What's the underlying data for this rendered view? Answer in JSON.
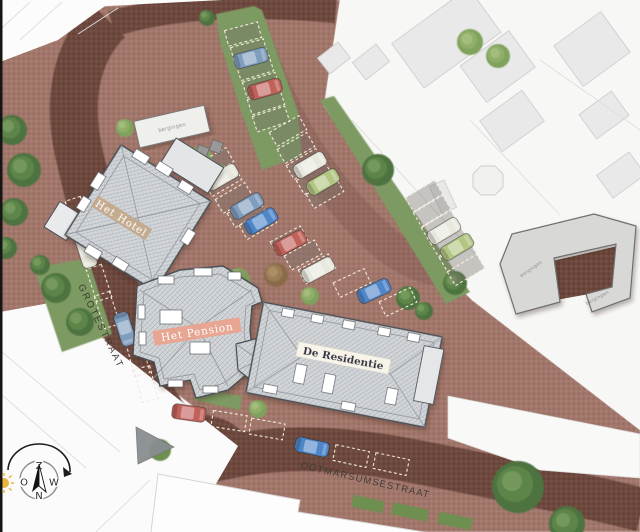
{
  "plan": {
    "labels": {
      "hotel": "Het Hotel",
      "pension": "Het Pension",
      "residentie": "De Residentie",
      "storage": "bergingen"
    },
    "streets": {
      "grotestraat": "GROTESTRAAT",
      "ootmarsumsestraat": "OOTMARSUMSESTRAAT"
    },
    "compass": {
      "top": "Z",
      "bottom": "N",
      "left": "O",
      "right": "W"
    },
    "colors": {
      "plaza_brick": "#a3766a",
      "road_brick": "#6e483d",
      "grass": "#7d9a62",
      "tree": "#4e7340",
      "building_gray": "#d3d6d9",
      "building_outline": "#4a4f55",
      "surrounding_building": "#e9e9e9",
      "hotel_label_bg": "#c4a98b",
      "pension_label_bg": "#e9a38f",
      "residentie_label_bg": "#f8f4ea",
      "label_text_light": "#ffffff",
      "label_text_dark": "#33333f",
      "car_blue": "#7f9dbd",
      "car_blue_dark": "#4f86c9",
      "car_red": "#c0615a",
      "car_white": "#e8e8df",
      "car_green": "#b3c583",
      "sun": "#e9b63b"
    }
  }
}
